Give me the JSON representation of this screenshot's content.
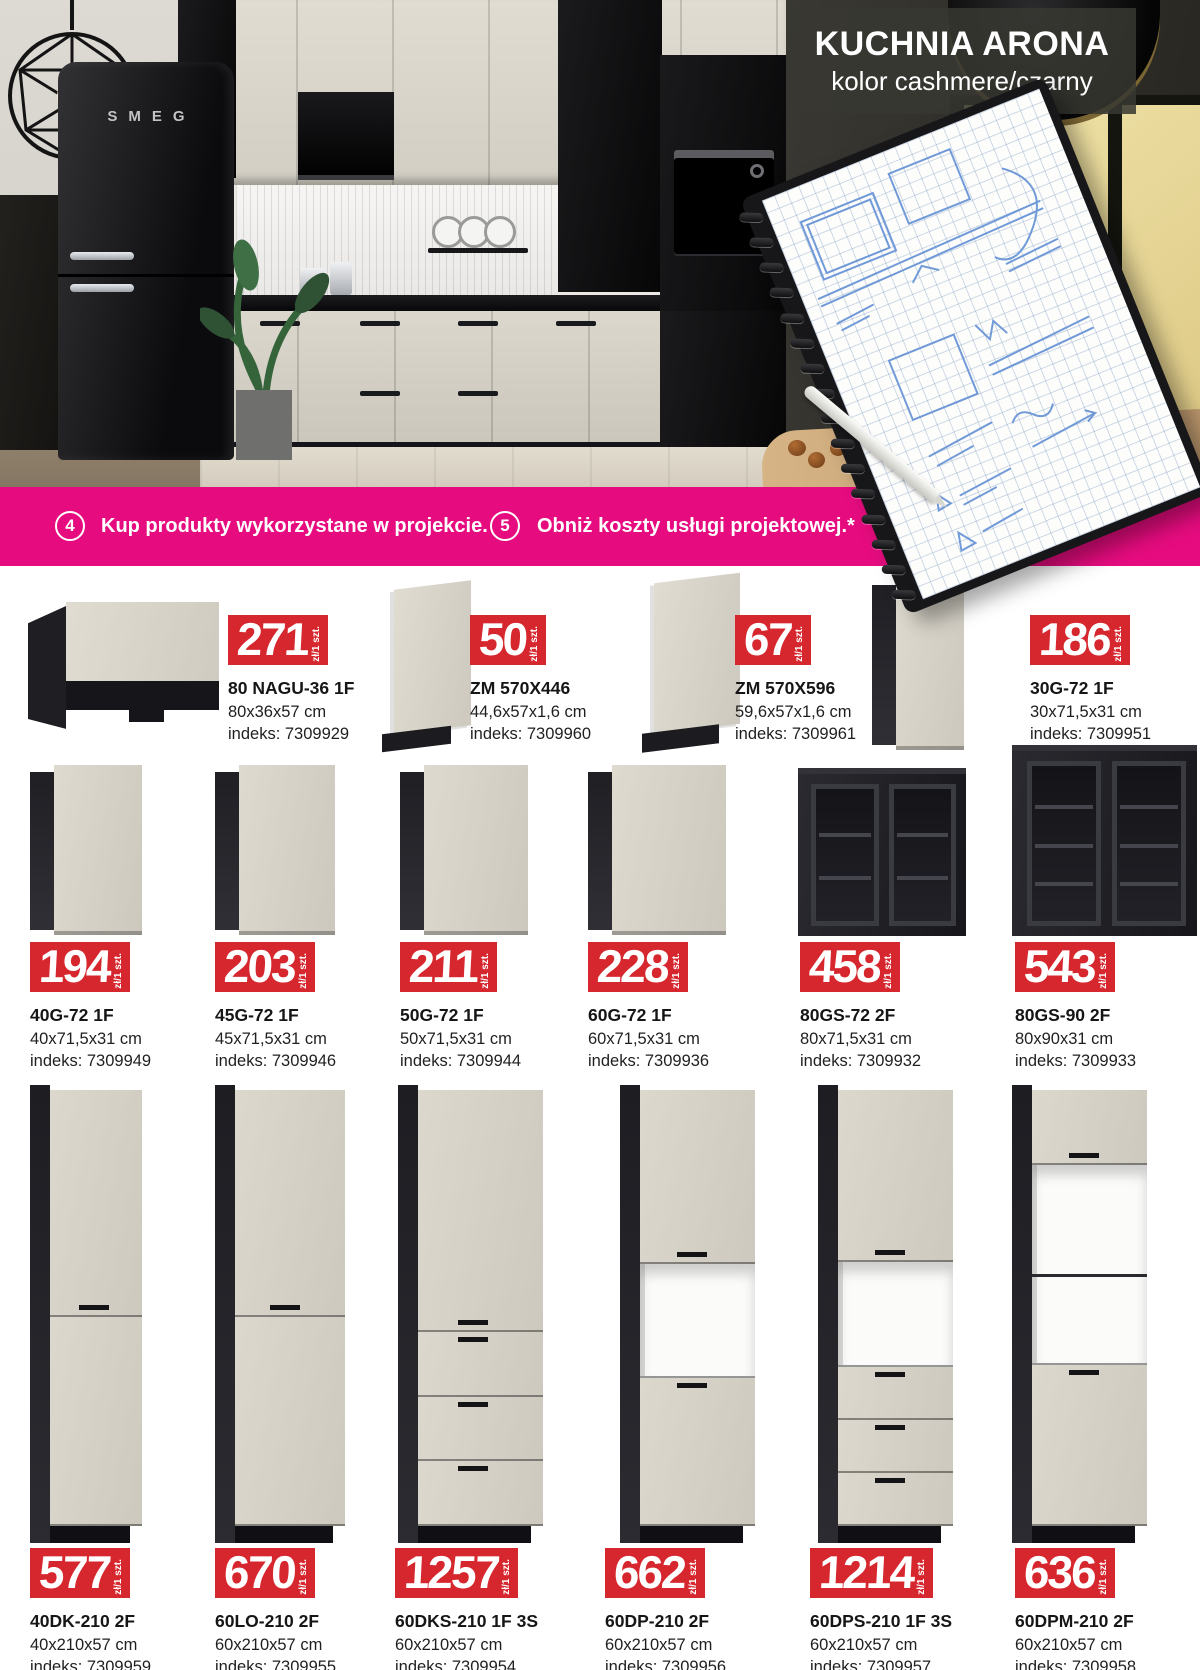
{
  "hero": {
    "title": "KUCHNIA ARONA",
    "subtitle": "kolor cashmere/czarny",
    "fridge_brand": "SMEG"
  },
  "banner": {
    "steps": [
      {
        "number": "4",
        "label": "Kup produkty wykorzystane w projekcie."
      },
      {
        "number": "5",
        "label": "Obniż koszty usługi projektowej.*"
      }
    ]
  },
  "labels": {
    "unit": "zł/1 szt.",
    "index_prefix": "indeks:"
  },
  "colors": {
    "accent_pink": "#e60c7f",
    "badge_red": "#d7272e",
    "cabinet_front": "#d8d4ca",
    "cabinet_carcass": "#26262b"
  },
  "products": {
    "row1": [
      {
        "price": "271",
        "name": "80 NAGU-36 1F",
        "dims": "80x36x57 cm",
        "index": "7309929"
      },
      {
        "price": "50",
        "name": "ZM 570X446",
        "dims": "44,6x57x1,6 cm",
        "index": "7309960"
      },
      {
        "price": "67",
        "name": "ZM 570X596",
        "dims": "59,6x57x1,6 cm",
        "index": "7309961"
      },
      {
        "price": "186",
        "name": "30G-72 1F",
        "dims": "30x71,5x31 cm",
        "index": "7309951"
      }
    ],
    "row2": [
      {
        "price": "194",
        "name": "40G-72 1F",
        "dims": "40x71,5x31 cm",
        "index": "7309949"
      },
      {
        "price": "203",
        "name": "45G-72 1F",
        "dims": "45x71,5x31 cm",
        "index": "7309946"
      },
      {
        "price": "211",
        "name": "50G-72 1F",
        "dims": "50x71,5x31 cm",
        "index": "7309944"
      },
      {
        "price": "228",
        "name": "60G-72 1F",
        "dims": "60x71,5x31 cm",
        "index": "7309936"
      },
      {
        "price": "458",
        "name": "80GS-72 2F",
        "dims": "80x71,5x31 cm",
        "index": "7309932"
      },
      {
        "price": "543",
        "name": "80GS-90 2F",
        "dims": "80x90x31 cm",
        "index": "7309933"
      }
    ],
    "row3": [
      {
        "price": "577",
        "name": "40DK-210 2F",
        "dims": "40x210x57 cm",
        "index": "7309959"
      },
      {
        "price": "670",
        "name": "60LO-210 2F",
        "dims": "60x210x57 cm",
        "index": "7309955"
      },
      {
        "price": "1257",
        "name": "60DKS-210 1F 3S",
        "dims": "60x210x57 cm",
        "index": "7309954"
      },
      {
        "price": "662",
        "name": "60DP-210 2F",
        "dims": "60x210x57 cm",
        "index": "7309956"
      },
      {
        "price": "1214",
        "name": "60DPS-210 1F 3S",
        "dims": "60x210x57 cm",
        "index": "7309957"
      },
      {
        "price": "636",
        "name": "60DPM-210 2F",
        "dims": "60x210x57 cm",
        "index": "7309958"
      }
    ]
  }
}
